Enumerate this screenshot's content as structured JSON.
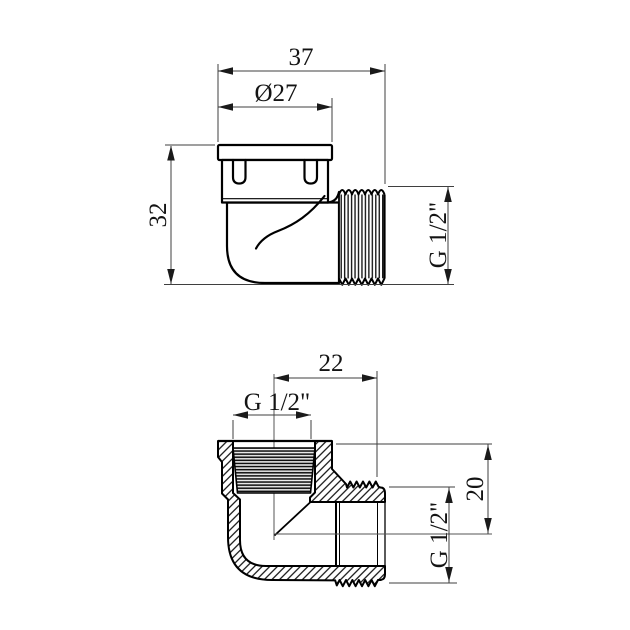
{
  "drawing": {
    "background": "#ffffff",
    "outline_color": "#000000",
    "dim_line_color": "#3f3f3f",
    "text_color": "#141414",
    "views": {
      "external": {
        "title": "external-side-view",
        "dims": {
          "overall_width": {
            "label": "37"
          },
          "cap_diameter": {
            "label": "Ø27"
          },
          "overall_height": {
            "label": "32"
          },
          "male_thread": {
            "label": "G 1/2\""
          }
        }
      },
      "section": {
        "title": "cross-section-view",
        "dims": {
          "port_offset": {
            "label": "22"
          },
          "female_thread": {
            "label": "G 1/2\""
          },
          "axis_height": {
            "label": "20"
          },
          "male_thread": {
            "label": "G 1/2\""
          }
        }
      }
    }
  }
}
